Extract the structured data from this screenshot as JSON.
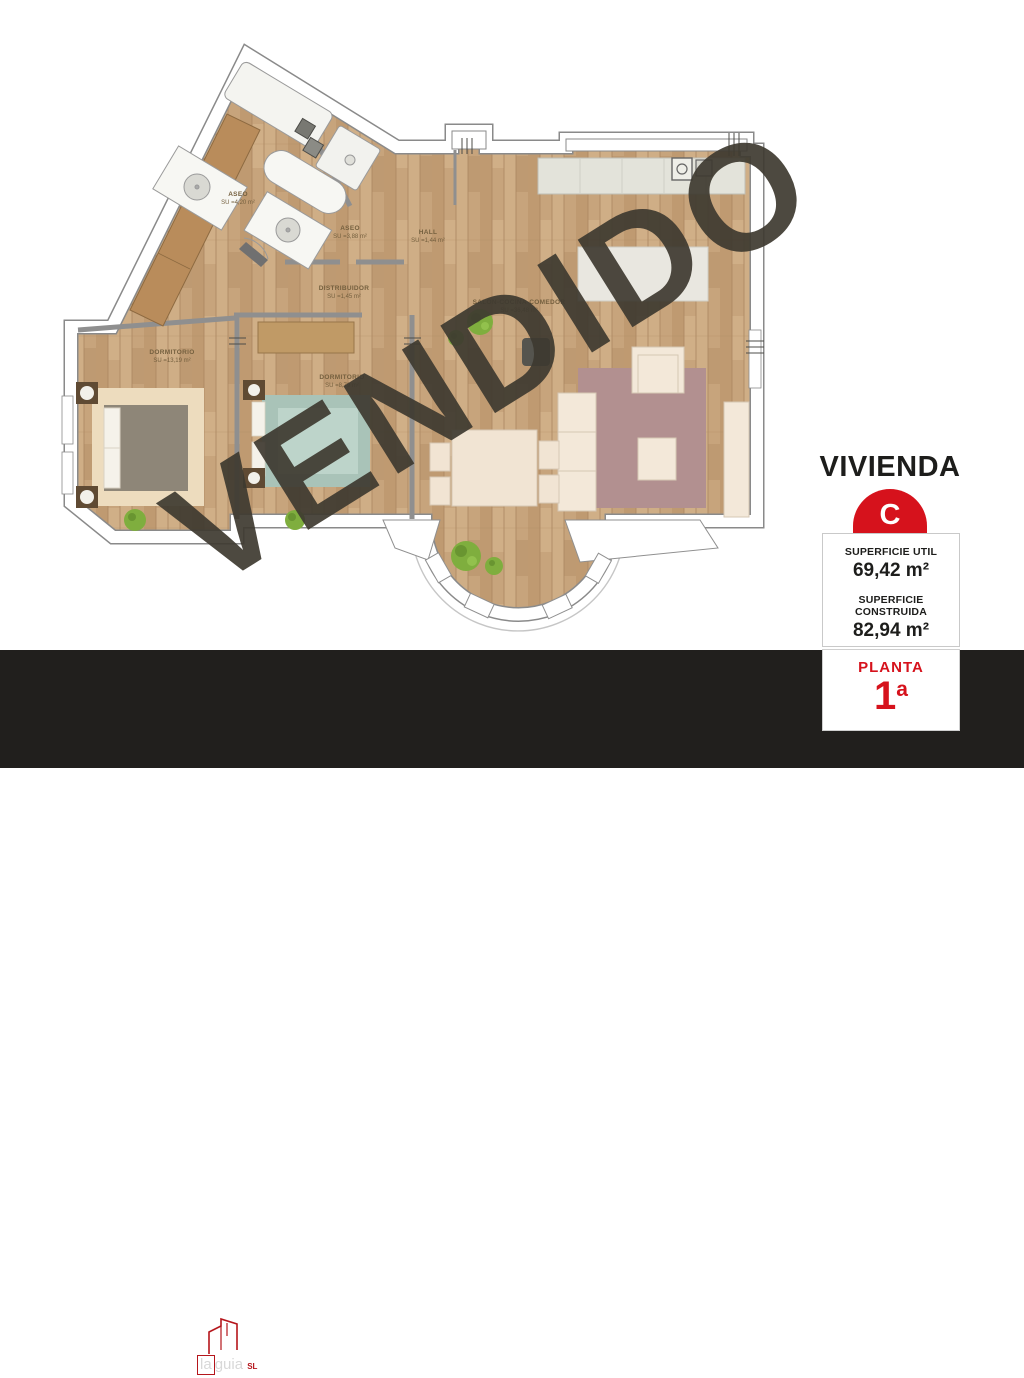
{
  "plan": {
    "watermark": "VENDIDO",
    "rooms": [
      {
        "name": "ASEO",
        "area": "SU =4,20 m²"
      },
      {
        "name": "ASEO",
        "area": "SU =3,88 m²"
      },
      {
        "name": "HALL",
        "area": "SU =1,44 m²"
      },
      {
        "name": "DISTRIBUIDOR",
        "area": "SU =1,45 m²"
      },
      {
        "name": "SALÓN-COCINA-COMEDOR",
        "area": "SU =36,48 m²"
      },
      {
        "name": "DORMITORIO",
        "area": "SU =13,19 m²"
      },
      {
        "name": "DORMITORIO",
        "area": "SU =8,79 m²"
      }
    ]
  },
  "sidebar": {
    "title": "VIVIENDA",
    "unit_letter": "C",
    "superficie_util_label": "SUPERFICIE UTIL",
    "superficie_util_value": "69,42 m²",
    "superficie_construida_label": "SUPERFICIE CONSTRUIDA",
    "superficie_construida_value": "82,94 m²",
    "planta_label": "PLANTA",
    "planta_number": "1",
    "planta_ordinal": "a"
  },
  "footer": {
    "brand": "GIJÓN",
    "brand_secondary_1": "la",
    "brand_secondary_2": "guia",
    "brand_suffix": "SL",
    "building": "Edificio Avda. Portugal 17",
    "estado": "ESTADO REFORMADO"
  },
  "colors": {
    "accent_red": "#d6121c",
    "footer_black": "#211f1d",
    "watermark_gray": "#3e3930",
    "wood_floor": "#c7a47c"
  }
}
